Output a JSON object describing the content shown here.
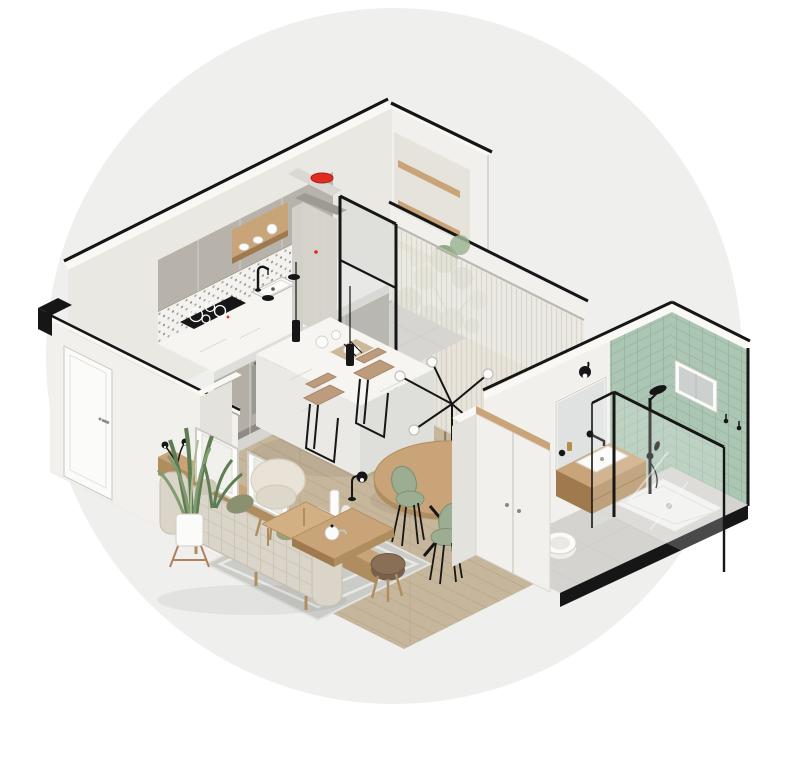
{
  "scene": {
    "description": "Isometric 3D cutaway illustration of a small studio apartment on a light gray circular backdrop",
    "view": "isometric",
    "backdrop": "large light gray circle on white"
  },
  "colors": {
    "pageBg": "#ffffff",
    "circleBg": "#efefee",
    "ink": "#161616",
    "wallFace": "#f1f0ec",
    "wallLight": "#f9f8f5",
    "wallShade": "#e4e2dc",
    "wallInner": "#eae8e2",
    "cabinet": "#b7b2aa",
    "cabinetDark": "#a39e96",
    "cabinetLight": "#d3d0ca",
    "marble": "#f6f5f2",
    "marbleSide": "#eae9e5",
    "marbleEdge": "#dededa",
    "vein": "#d8d7d3",
    "wood": "#c8a478",
    "woodDark": "#b08d5e",
    "woodDeep": "#9f7a4e",
    "woodFloor": "#c6b69b",
    "plank": "#b5a589",
    "tileFloor": "#d6d5d1",
    "grout": "#c2c1bd",
    "greenTile": "#abc6b3",
    "greenLine": "#96b19e",
    "sage": "#9cad92",
    "sageDark": "#7f9277",
    "sofaBeige": "#dad5c8",
    "sofaLine": "#b9b4a6",
    "pillowOlive": "#8b9070",
    "cream": "#e8e3d6",
    "tanSeat": "#bd9c7e",
    "brownSeat": "#8a6f57",
    "rug": "#cbcbc8",
    "rugPat": "#e8e8e6",
    "red": "#e02b20",
    "leaf": "#7f9d6e",
    "leafDark": "#5f7d54",
    "steel": "#9a9894",
    "porcelain": "#fbfbf9",
    "outline": "#d2cfc9"
  },
  "rooms": [
    {
      "name": "kitchen",
      "items": [
        "gray upper cabinets",
        "open wood shelf with white dishes",
        "patterned tile backsplash",
        "marble countertop",
        "black faucet and sink",
        "induction cooktop",
        "built-in oven",
        "tall fridge column with red bowl on top",
        "black framed glass partition",
        "two black pendant lights"
      ]
    },
    {
      "name": "entry-nook",
      "items": [
        "white walls",
        "three wood wall shelves",
        "white entry door with steel handle",
        "black wall caps"
      ]
    },
    {
      "name": "dining",
      "items": [
        "marble kitchen island with tableware",
        "two tan bar stools",
        "round wood dining table",
        "three sage green chairs",
        "black spider chandelier with white globe bulbs",
        "sheer curtain wall",
        "potted eucalyptus tree",
        "tall white wardrobe"
      ]
    },
    {
      "name": "living",
      "items": [
        "beige sofa with grid throw and olive pillows",
        "wood console with two white picture frames",
        "black table lamp",
        "white vases",
        "snake plant in white pot on wood stand",
        "cream armchair",
        "two nesting wood coffee tables with white teapot",
        "brown stool",
        "gray diamond-pattern rug",
        "wood plank floor"
      ]
    },
    {
      "name": "bathroom",
      "items": [
        "sage green tiled walls",
        "small window",
        "black framed glass shower with white tray",
        "black shower column",
        "wood vanity with white basin and black wall faucet",
        "mirror with black sconce",
        "wall-hung toilet",
        "gray tile floor",
        "two black wall hooks"
      ]
    }
  ]
}
